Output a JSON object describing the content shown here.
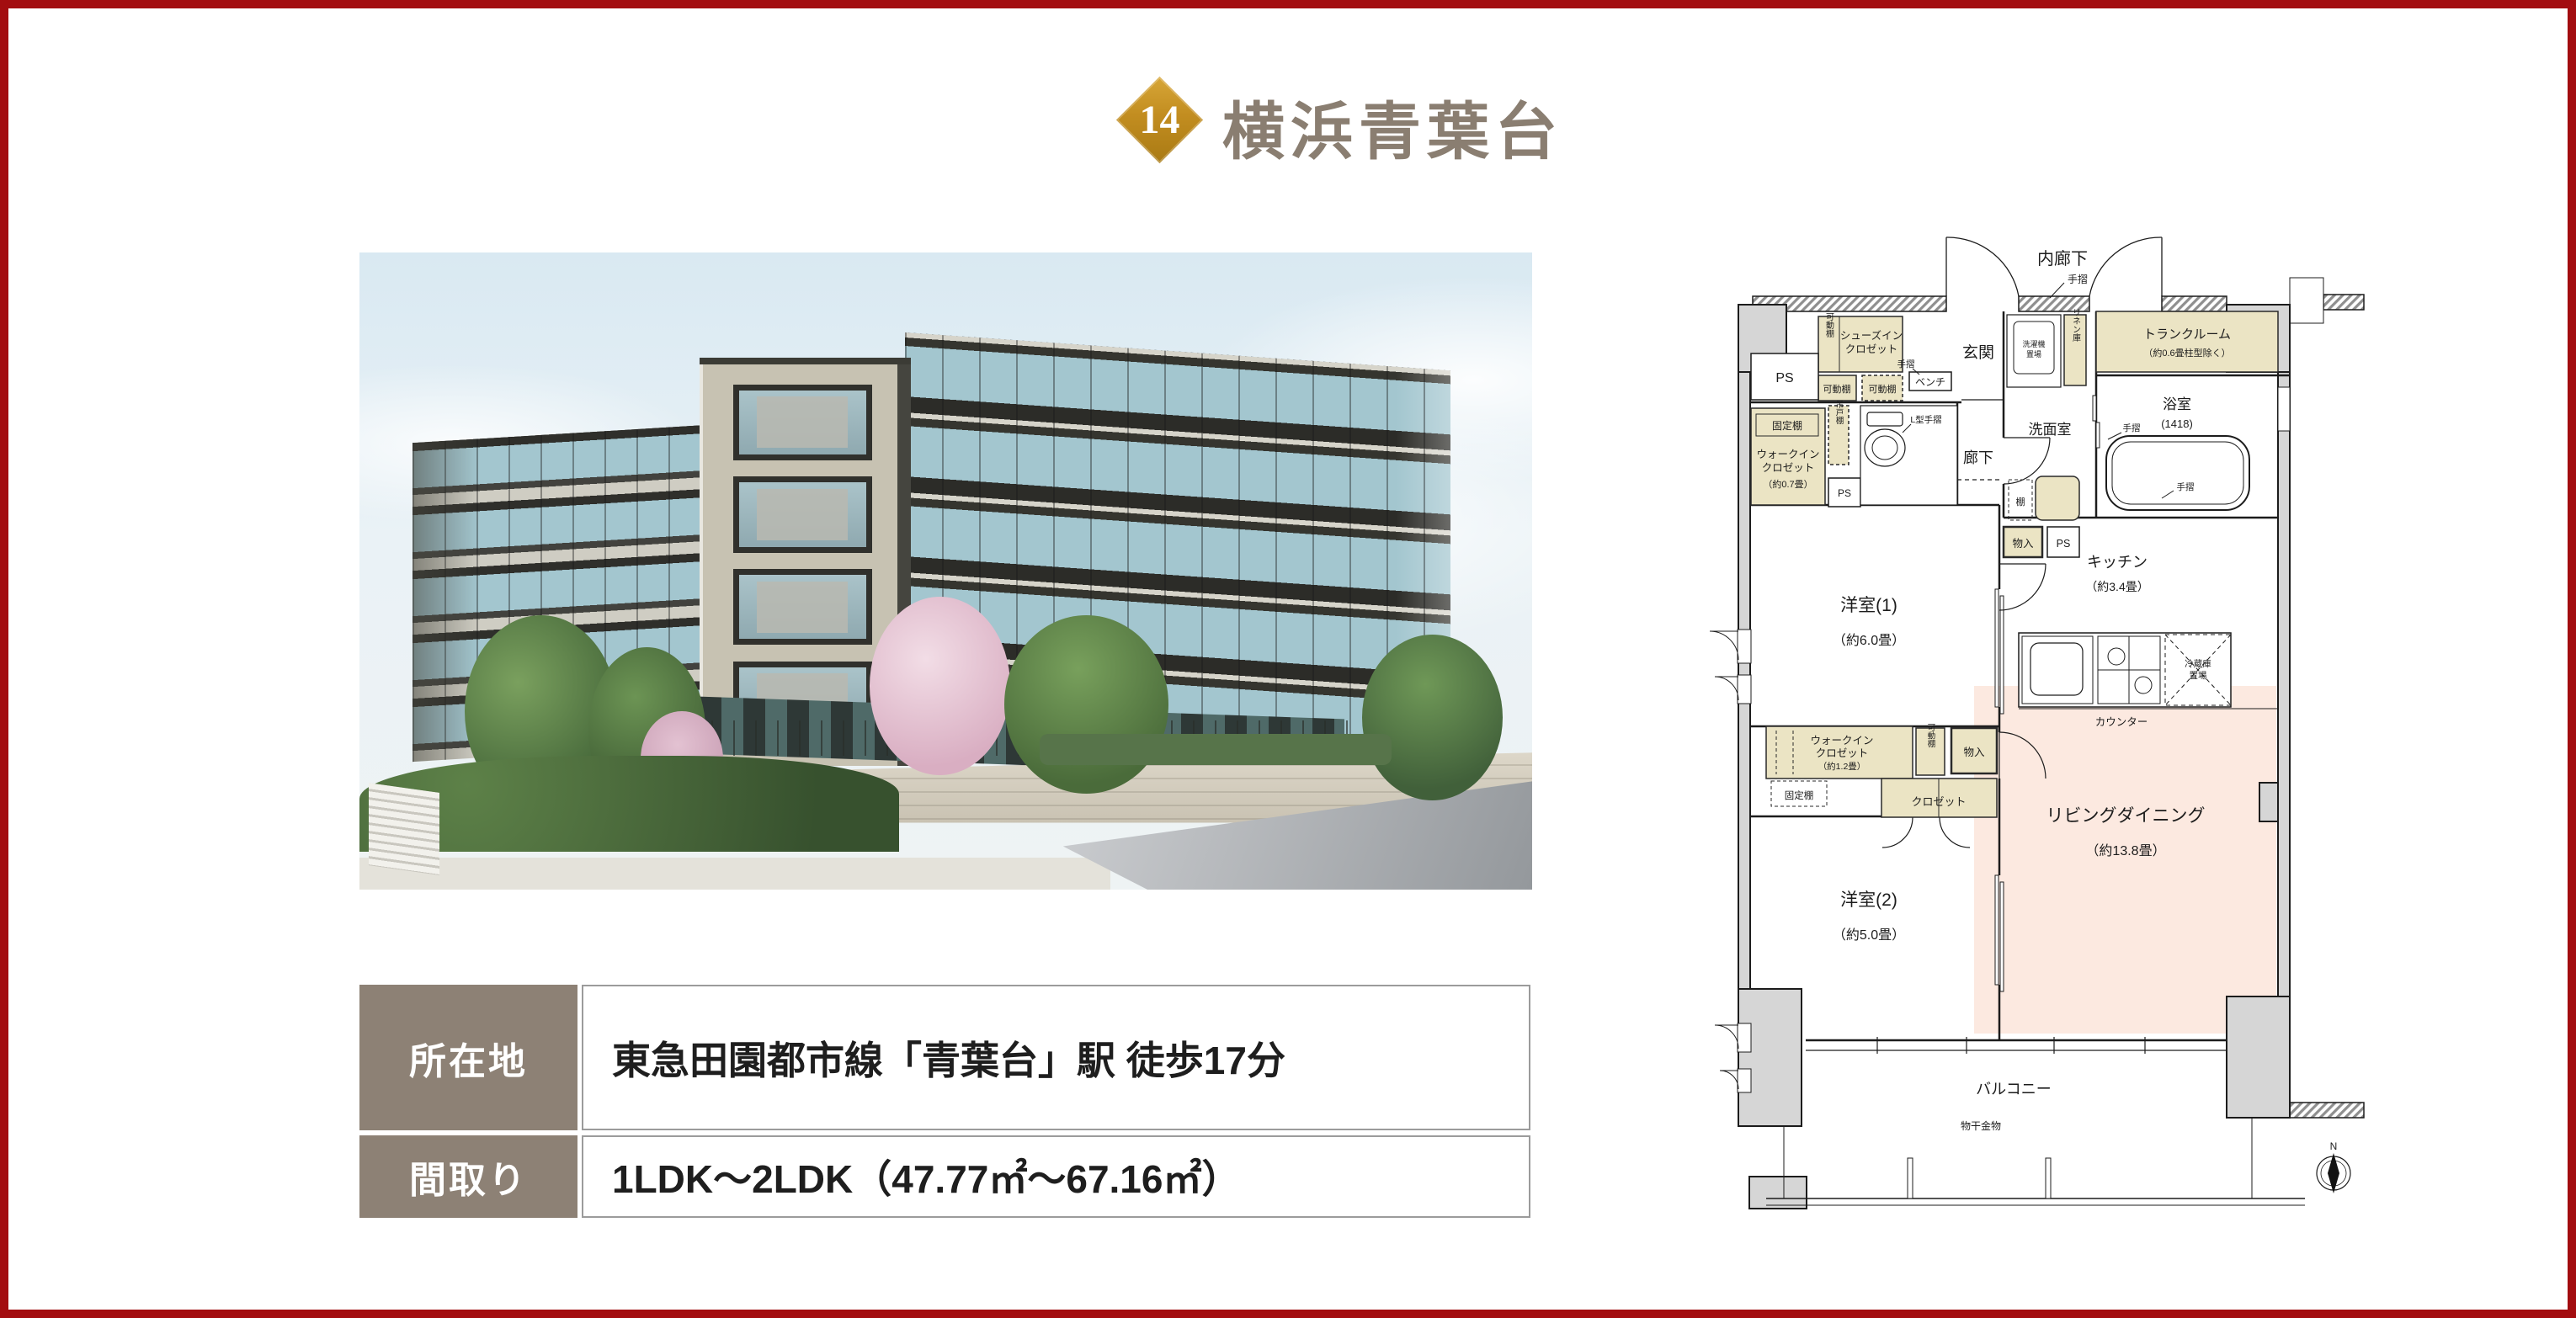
{
  "page": {
    "frame_color": "#a30d10",
    "background": "#ffffff"
  },
  "header": {
    "badge_number": "14",
    "badge_color": "#c28d20",
    "title": "横浜青葉台",
    "title_color": "#8a7e71"
  },
  "info_table": {
    "label_bg": "#8d8175",
    "rows": [
      {
        "label": "所在地",
        "value": "東急田園都市線「青葉台」駅 徒歩17分"
      },
      {
        "label": "間取り",
        "value": "1LDK〜2LDK（47.77㎡〜67.16㎡）"
      }
    ]
  },
  "floorplan": {
    "colors": {
      "closet_fill": "#ebe4c4",
      "living_fill": "#fce9e0",
      "pillar_fill": "#d6d6d6"
    },
    "labels": {
      "inner_corridor": "内廊下",
      "tesuri_1": "手摺",
      "tesuri_2": "手摺",
      "tesuri_3": "手摺",
      "tesuri_4": "手摺",
      "l_tesuri": "L型手摺",
      "entrance": "玄関",
      "sic_1": "シューズイン",
      "sic_2": "クロゼット",
      "kadou_1": "可動棚",
      "kadou_2": "可動棚",
      "kadou_3": "可動棚",
      "kadou_4": "可動棚",
      "bench": "ベンチ",
      "ps_1": "PS",
      "ps_2": "PS",
      "ps_3": "PS",
      "kotei_1": "固定棚",
      "kotei_2": "固定棚",
      "wic1_1": "ウォークイン",
      "wic1_2": "クロゼット",
      "wic1_3": "（約0.7畳）",
      "tsurito": "吊戸棚",
      "corridor": "廊下",
      "washroom": "洗面室",
      "washer_1": "洗濯機",
      "washer_2": "置場",
      "linen": "リネン庫",
      "trunk_1": "トランクルーム",
      "trunk_2": "（約0.6畳柱型除く）",
      "bath": "浴室",
      "bath_size": "(1418)",
      "shelf": "棚",
      "storage_1": "物入",
      "storage_2": "物入",
      "kitchen": "キッチン",
      "kitchen_size": "（約3.4畳）",
      "fridge_1": "冷蔵庫",
      "fridge_2": "置場",
      "counter": "カウンター",
      "living": "リビングダイニング",
      "living_size": "（約13.8畳）",
      "wic2_1": "ウォークイン",
      "wic2_2": "クロゼット",
      "wic2_3": "（約1.2畳）",
      "closet": "クロゼット",
      "room1": "洋室(1)",
      "room1_size": "（約6.0畳）",
      "room2": "洋室(2)",
      "room2_size": "（約5.0畳）",
      "balcony": "バルコニー",
      "drying": "物干金物",
      "compass_n": "N"
    }
  }
}
